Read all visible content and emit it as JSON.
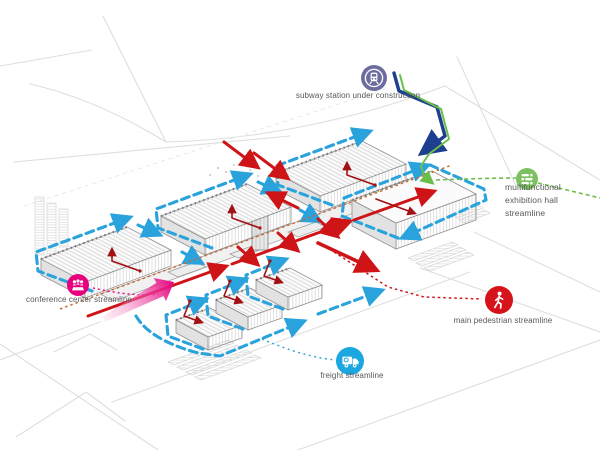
{
  "legend": {
    "subway": {
      "label": "subway station under construction",
      "icon": "train-icon"
    },
    "exhibition": {
      "line1": "multifunctional",
      "line2": "exhibition hall",
      "line3": "streamline",
      "icon": "list-icon"
    },
    "conference": {
      "label": "conference center streamline",
      "icon": "audience-icon"
    },
    "pedestrian": {
      "label": "main pedestrian streamline",
      "icon": "pedestrian-icon"
    },
    "freight": {
      "label": "freight streamline",
      "icon": "truck-icon"
    }
  },
  "colors": {
    "canvas": "#ffffff",
    "freight_blue": "#2aa3dc",
    "pedestrian_red": "#cf1418",
    "branch_darkred": "#a21114",
    "axis_orange_dotted": "#c76a35",
    "conference_pink": "#e6007e",
    "subway_navy": "#1d3f8f",
    "subway_green": "#6abf4b",
    "icon_green": "#7cc15f",
    "icon_purple": "#6c6d9e",
    "icon_red": "#d6131b",
    "icon_blue": "#1ba7df",
    "label_text": "#58585a"
  }
}
